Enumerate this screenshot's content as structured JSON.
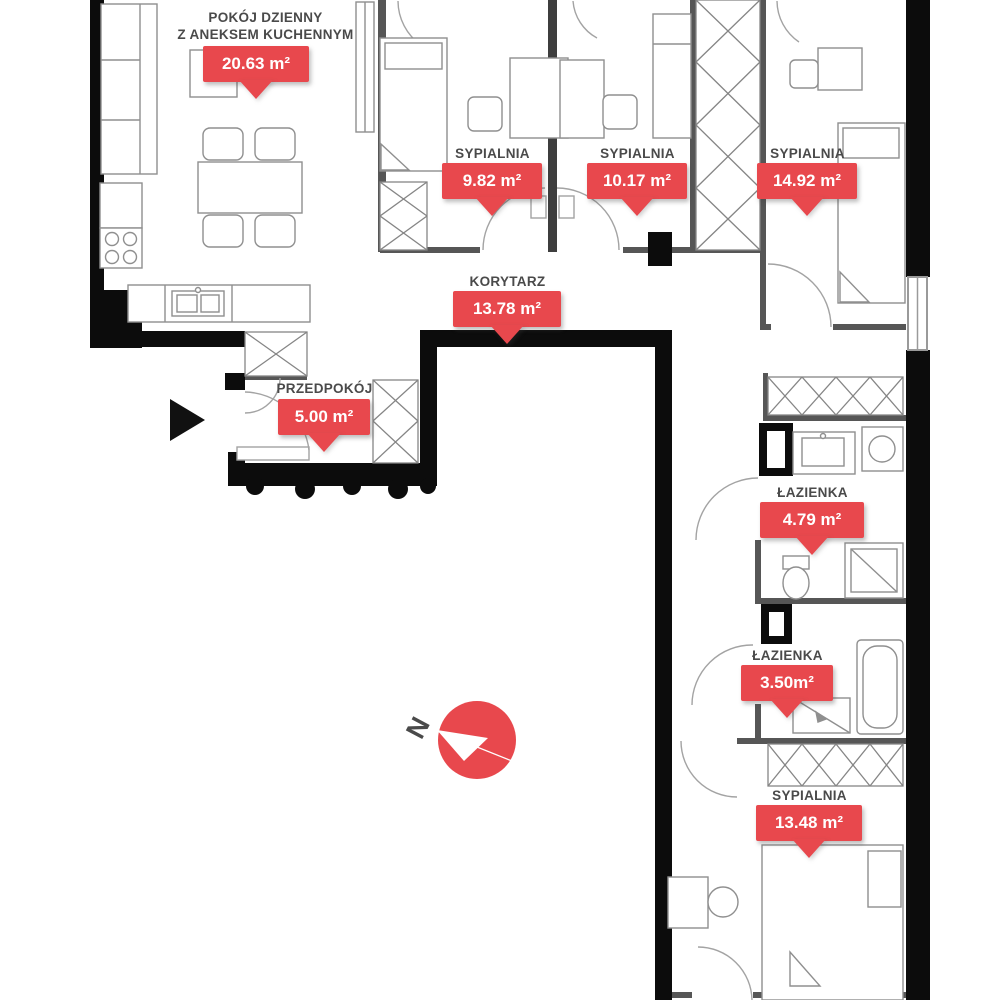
{
  "plan": {
    "rooms": [
      {
        "id": "living-room",
        "name": "POKÓJ DZIENNY\nZ ANEKSEM KUCHENNYM",
        "area": "20.63 m²"
      },
      {
        "id": "bedroom-1",
        "name": "SYPIALNIA",
        "area": "9.82 m²"
      },
      {
        "id": "bedroom-2",
        "name": "SYPIALNIA",
        "area": "10.17 m²"
      },
      {
        "id": "bedroom-3",
        "name": "SYPIALNIA",
        "area": "14.92 m²"
      },
      {
        "id": "corridor",
        "name": "KORYTARZ",
        "area": "13.78 m²"
      },
      {
        "id": "entrance-hall",
        "name": "PRZEDPOKÓJ",
        "area": "5.00 m²"
      },
      {
        "id": "bathroom-1",
        "name": "ŁAZIENKA",
        "area": "4.79 m²"
      },
      {
        "id": "bathroom-2",
        "name": "ŁAZIENKA",
        "area": "3.50m²"
      },
      {
        "id": "bedroom-4",
        "name": "SYPIALNIA",
        "area": "13.48 m²"
      }
    ],
    "compass": {
      "label": "N"
    },
    "colors": {
      "accent": "#e8484d",
      "wall": "#0c0c0c",
      "label_text": "#4a4a4a"
    }
  }
}
